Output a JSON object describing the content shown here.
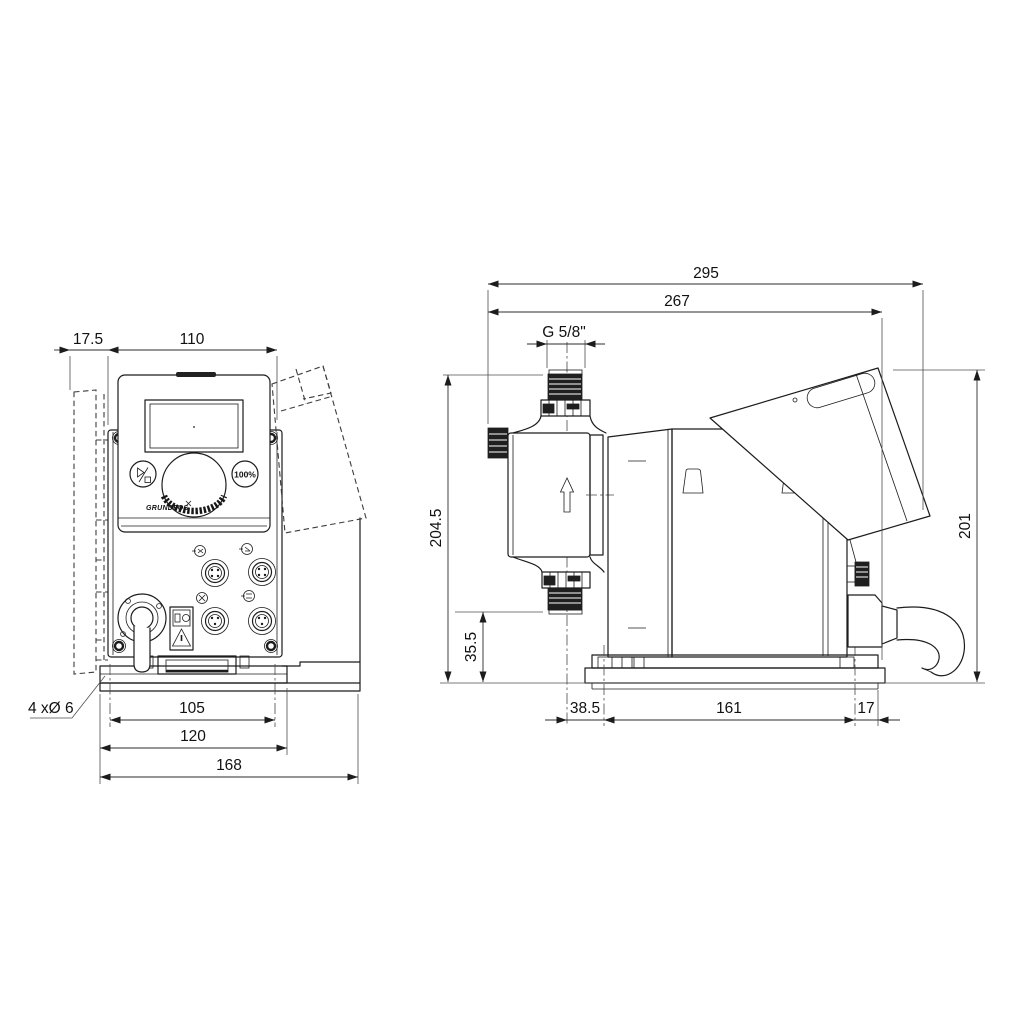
{
  "front_view": {
    "dim_offset_left": "17.5",
    "dim_width": "110",
    "dim_hole_pitch": "105",
    "dim_plate_width": "120",
    "dim_overall_width": "168",
    "holes_label": "4 xØ 6",
    "logo": "GRUNDFOS",
    "button_100_label": "100%"
  },
  "side_view": {
    "dim_overall_depth": "295",
    "dim_depth_to_mount": "267",
    "thread_label": "G 5/8\"",
    "dim_height_overall": "204.5",
    "dim_inlet_height": "35.5",
    "dim_head_offset": "38.5",
    "dim_slot_pitch": "161",
    "dim_rear_offset": "17",
    "dim_rear_height": "201"
  },
  "colors": {
    "line": "#1c1c1c",
    "dim_line": "#2b2b2b",
    "background": "#ffffff"
  }
}
